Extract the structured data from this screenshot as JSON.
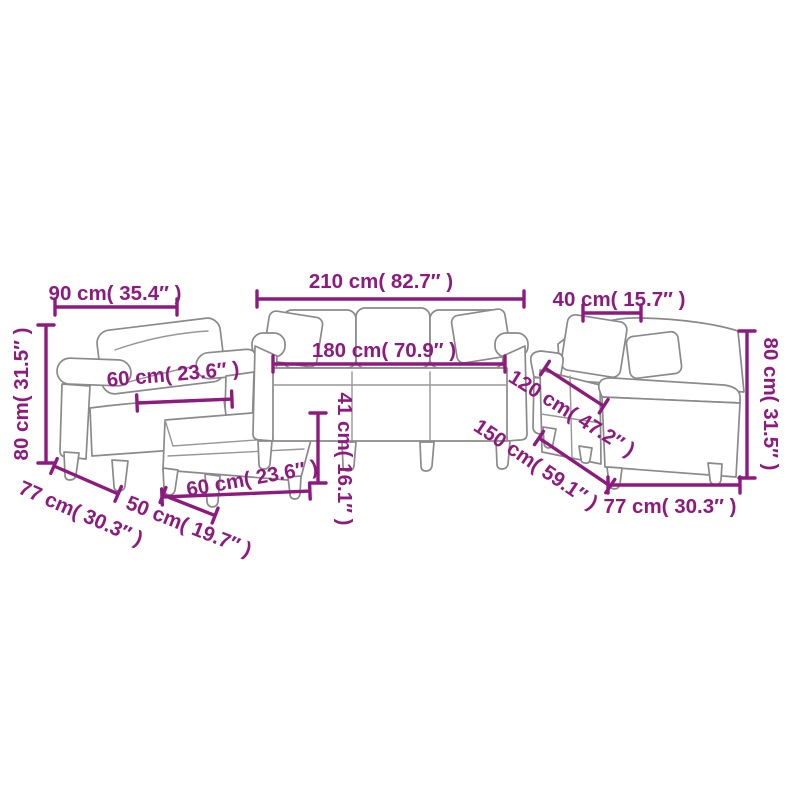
{
  "diagram": {
    "description": "Sofa set line-art dimension diagram: armchair with footstool, 3-seater sofa, 2-seater sofa",
    "accent_color": "#8e1a7f",
    "furniture_line_color": "#8a8a8a",
    "background_color": "#ffffff",
    "labels": {
      "armchair_width": "90 cm( 35.4″ )",
      "armchair_height": "80 cm( 31.5″ )",
      "armchair_seat_width": "60 cm( 23.6″ )",
      "armchair_depth": "77 cm( 30.3″ )",
      "sofa_width": "210 cm( 82.7″ )",
      "sofa_inner_width": "180 cm( 70.9″ )",
      "seat_height": "41 cm( 16.1″ )",
      "footstool_width": "60 cm( 23.6″ )",
      "footstool_depth": "50 cm( 19.7″ )",
      "cushion_width": "40 cm( 15.7″ )",
      "loveseat_height": "80 cm( 31.5″ )",
      "loveseat_inner_width": "120 cm( 47.2″ )",
      "loveseat_width": "150 cm( 59.1″ )",
      "loveseat_depth": "77 cm( 30.3″ )"
    }
  }
}
